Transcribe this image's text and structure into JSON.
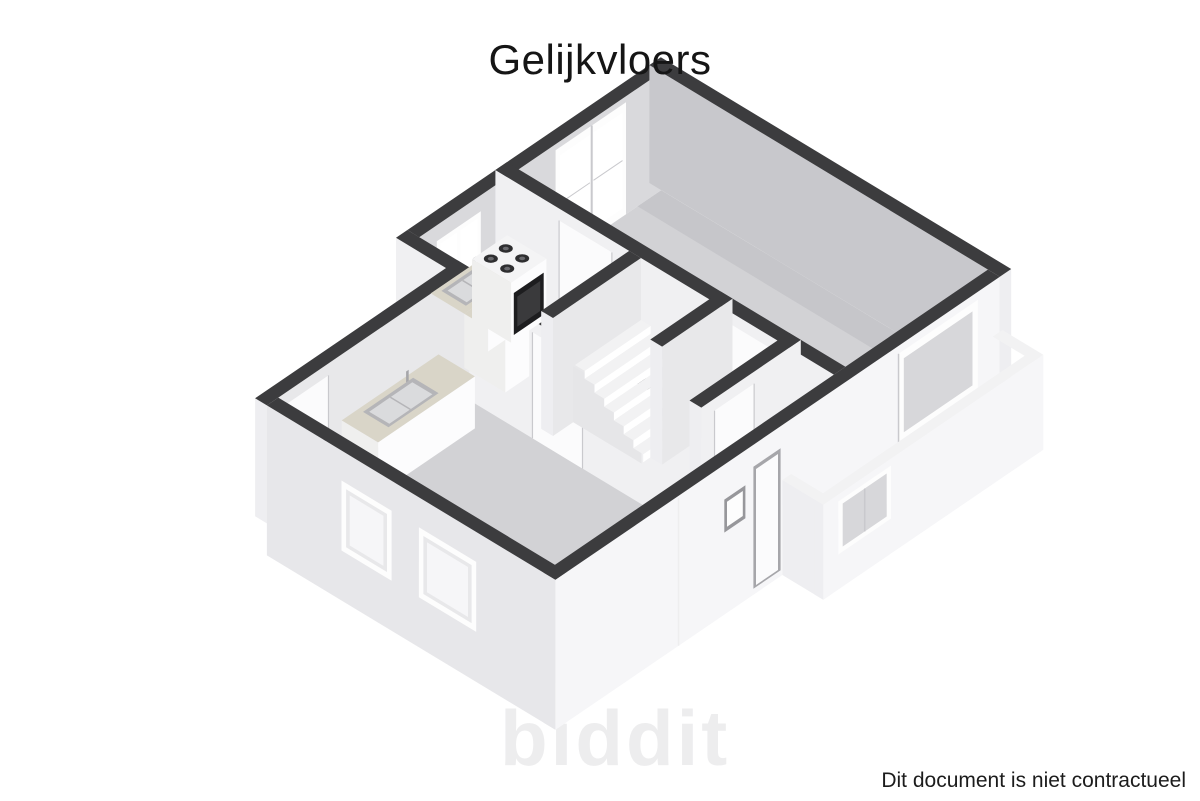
{
  "title": "Gelijkvloers",
  "footer": {
    "disclaimer": "Dit document is niet contractueel"
  },
  "watermark": "biddit",
  "palette": {
    "background": "#ffffff",
    "wall_top": "#3c3c3e",
    "annex_wall_top": "#f2f2f3",
    "floor": "#d2d2d5",
    "floor_shadow": "#c6c6ca",
    "annex_floor": "#fcfcfd",
    "wall_inner_nw": "#d9d9dc",
    "wall_inner_ne": "#c8c8cc",
    "wall_inner_lit": "#f0f0f2",
    "wall_inner_soft": "#e8e8ea",
    "exterior_lit": "#f6f6f8",
    "exterior_shadow": "#e7e7ea",
    "cap_light": "#eeeef1",
    "counter_top": "#d9d5c8",
    "counter_front": "#fcfcfd",
    "counter_side": "#efefee",
    "sink_rim": "#b5b5b8",
    "sink_basin": "#dadbdd",
    "stove_top": "#f4f4f5",
    "burner": "#2e2e30",
    "burner_ring": "#6a6a6e",
    "oven_front": "#1d1d1f",
    "oven_inner": "#3a3a3c",
    "glass": "#d7d7da",
    "glass_bright": "#ffffff",
    "frame_white": "#fdfdfd",
    "frame_line": "#c9c9cd",
    "door_leaf": "#fbfbfc",
    "door_jamb": "#a6a6aa",
    "inset_dark": "#97979b",
    "step_top": "#f2f2f3",
    "step_riser": "#ffffff",
    "stair_side": "#e6e6e8",
    "hatch": "#eeeeef"
  }
}
